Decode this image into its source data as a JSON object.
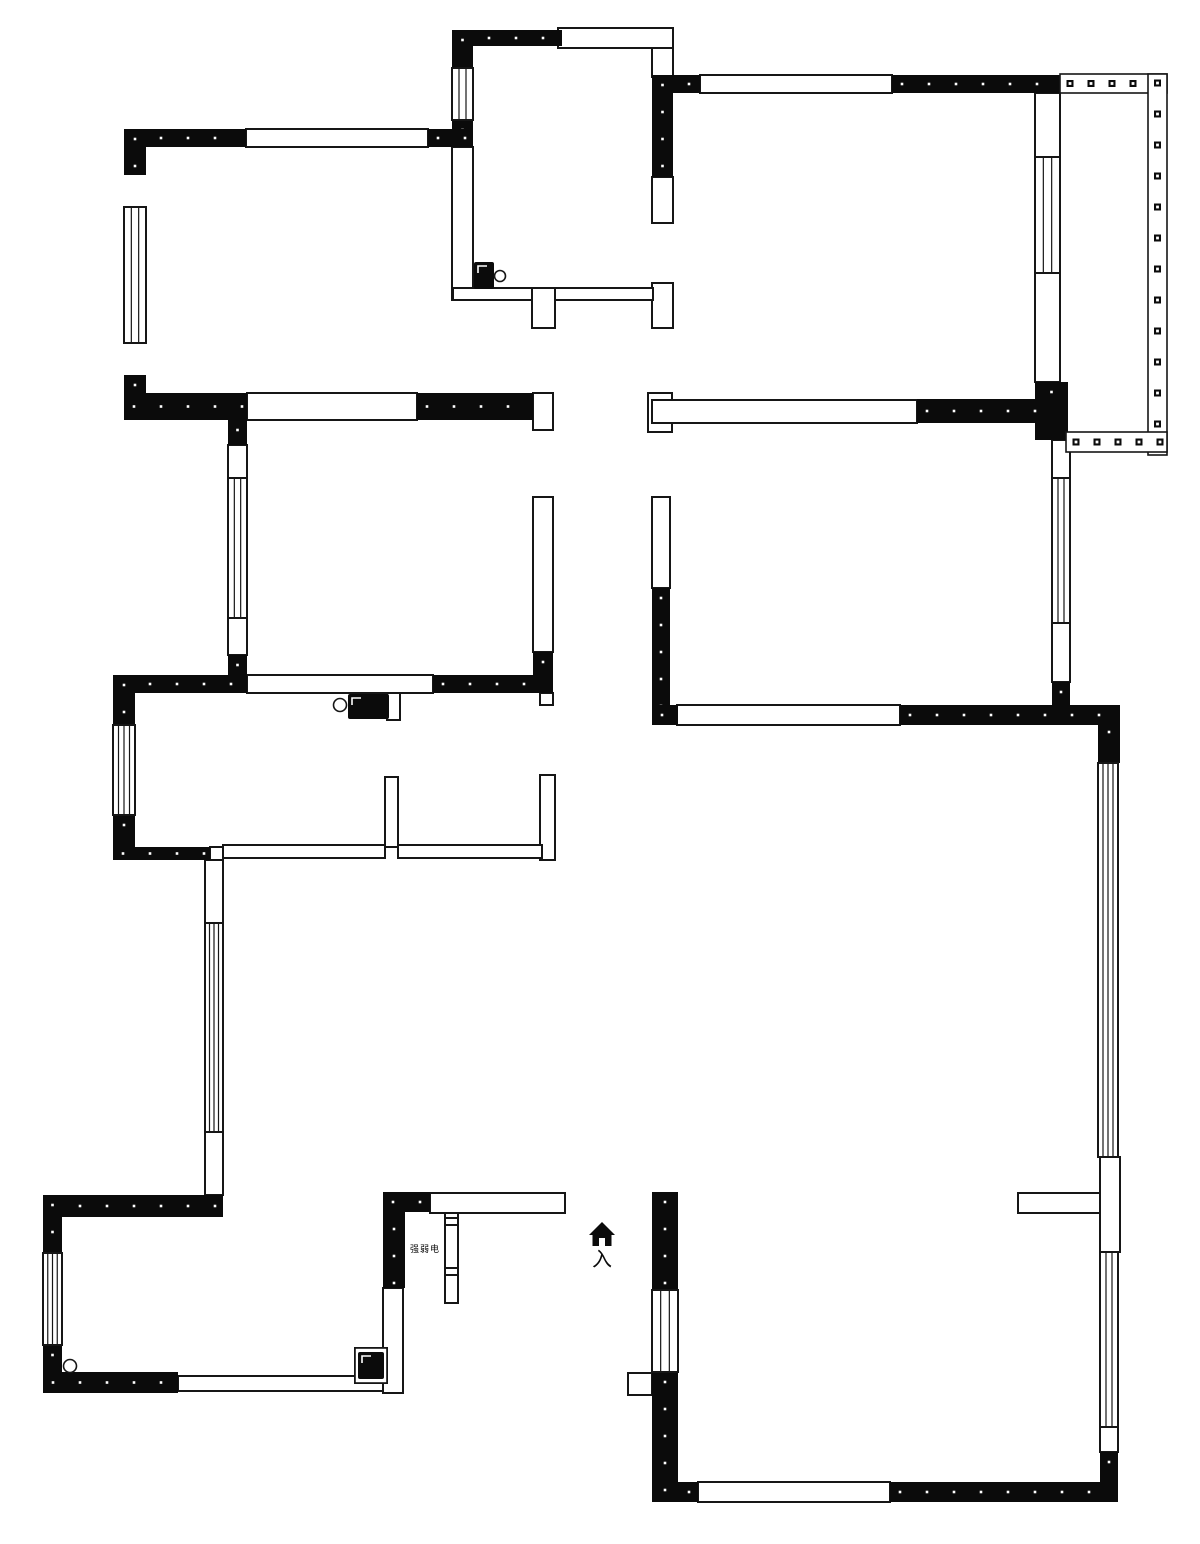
{
  "plan": {
    "canvas": {
      "width": 1200,
      "height": 1544
    },
    "colors": {
      "background": "#ffffff",
      "wall_fill": "#0b0b0b",
      "line": "#161616",
      "dot": "#ffffff"
    },
    "entrance": {
      "label": "入"
    },
    "closet": {
      "label": "强弱电"
    },
    "solid_walls": [
      [
        452,
        30,
        110,
        16
      ],
      [
        452,
        30,
        21,
        38
      ],
      [
        452,
        120,
        21,
        27
      ],
      [
        124,
        129,
        122,
        18
      ],
      [
        428,
        129,
        45,
        18
      ],
      [
        124,
        129,
        22,
        46
      ],
      [
        124,
        375,
        22,
        45
      ],
      [
        652,
        75,
        48,
        18
      ],
      [
        892,
        75,
        168,
        18
      ],
      [
        652,
        75,
        21,
        102
      ],
      [
        1035,
        382,
        33,
        58
      ],
      [
        917,
        399,
        143,
        24
      ],
      [
        124,
        393,
        123,
        27
      ],
      [
        417,
        393,
        116,
        27
      ],
      [
        228,
        420,
        19,
        25
      ],
      [
        228,
        655,
        19,
        38
      ],
      [
        113,
        675,
        134,
        18
      ],
      [
        433,
        675,
        120,
        18
      ],
      [
        113,
        675,
        22,
        50
      ],
      [
        113,
        815,
        22,
        45
      ],
      [
        113,
        847,
        97,
        13
      ],
      [
        533,
        652,
        20,
        41
      ],
      [
        652,
        588,
        18,
        137
      ],
      [
        652,
        705,
        26,
        20
      ],
      [
        900,
        705,
        220,
        20
      ],
      [
        1052,
        682,
        18,
        23
      ],
      [
        1098,
        722,
        22,
        41
      ],
      [
        1100,
        1452,
        18,
        50
      ],
      [
        890,
        1482,
        228,
        20
      ],
      [
        652,
        1482,
        46,
        20
      ],
      [
        652,
        1192,
        26,
        98
      ],
      [
        652,
        1372,
        26,
        130
      ],
      [
        43,
        1195,
        180,
        22
      ],
      [
        43,
        1195,
        19,
        58
      ],
      [
        43,
        1345,
        19,
        48
      ],
      [
        43,
        1372,
        135,
        21
      ],
      [
        383,
        1192,
        22,
        96
      ],
      [
        383,
        1192,
        47,
        20
      ]
    ],
    "outline_walls": [
      [
        558,
        28,
        115,
        20
      ],
      [
        652,
        48,
        21,
        29
      ],
      [
        452,
        147,
        21,
        153
      ],
      [
        246,
        129,
        182,
        18
      ],
      [
        700,
        75,
        192,
        18
      ],
      [
        652,
        177,
        21,
        46
      ],
      [
        652,
        283,
        21,
        45
      ],
      [
        453,
        288,
        200,
        12
      ],
      [
        532,
        288,
        23,
        40
      ],
      [
        1035,
        93,
        25,
        64
      ],
      [
        1035,
        273,
        25,
        109
      ],
      [
        247,
        393,
        170,
        27
      ],
      [
        533,
        393,
        20,
        37
      ],
      [
        648,
        393,
        24,
        39
      ],
      [
        652,
        400,
        265,
        23
      ],
      [
        228,
        445,
        19,
        33
      ],
      [
        228,
        618,
        19,
        37
      ],
      [
        533,
        497,
        20,
        155
      ],
      [
        652,
        497,
        18,
        91
      ],
      [
        1052,
        440,
        18,
        38
      ],
      [
        1052,
        623,
        18,
        59
      ],
      [
        247,
        675,
        186,
        18
      ],
      [
        677,
        705,
        223,
        20
      ],
      [
        540,
        693,
        13,
        12
      ],
      [
        385,
        777,
        13,
        70
      ],
      [
        540,
        775,
        15,
        85
      ],
      [
        210,
        847,
        13,
        13
      ],
      [
        223,
        845,
        162,
        13
      ],
      [
        398,
        845,
        144,
        13
      ],
      [
        205,
        860,
        18,
        63
      ],
      [
        205,
        1132,
        18,
        63
      ],
      [
        1100,
        1157,
        20,
        95
      ],
      [
        1018,
        1193,
        82,
        20
      ],
      [
        1100,
        1427,
        18,
        25
      ],
      [
        698,
        1482,
        192,
        20
      ],
      [
        628,
        1373,
        24,
        22
      ],
      [
        383,
        1288,
        20,
        105
      ],
      [
        430,
        1193,
        135,
        20
      ],
      [
        445,
        1213,
        13,
        90
      ],
      [
        445,
        1218,
        13,
        7
      ],
      [
        445,
        1268,
        13,
        7
      ],
      [
        178,
        1376,
        205,
        15
      ],
      [
        355,
        1348,
        32,
        35
      ],
      [
        387,
        693,
        13,
        27
      ]
    ],
    "windows": [
      [
        124,
        207,
        22,
        136,
        2
      ],
      [
        452,
        68,
        21,
        52,
        2
      ],
      [
        228,
        478,
        19,
        140,
        2
      ],
      [
        113,
        725,
        22,
        90,
        3
      ],
      [
        43,
        1253,
        19,
        92,
        3
      ],
      [
        205,
        923,
        18,
        209,
        3
      ],
      [
        1035,
        157,
        25,
        116,
        2
      ],
      [
        1052,
        478,
        18,
        145,
        2
      ],
      [
        1098,
        763,
        20,
        394,
        3
      ],
      [
        1100,
        1252,
        18,
        175,
        2
      ],
      [
        652,
        1290,
        26,
        82,
        2
      ]
    ],
    "railings": [
      [
        1060,
        74,
        107,
        19,
        "h"
      ],
      [
        1148,
        74,
        19,
        381,
        "v"
      ],
      [
        1066,
        432,
        101,
        20,
        "h"
      ]
    ],
    "fixtures": {
      "toilet": {
        "box": [
          474,
          262,
          20,
          27
        ],
        "circle": [
          500,
          276,
          5.5
        ]
      },
      "stove": {
        "box": [
          348,
          694,
          41,
          25
        ],
        "circle": [
          340,
          705,
          6.5
        ]
      },
      "water_heater": {
        "outer": [
          355,
          1348,
          32,
          35
        ],
        "box": [
          358,
          1352,
          26,
          27
        ]
      },
      "floor_drain": {
        "circle": [
          70,
          1366,
          6.5
        ]
      },
      "entrance_icon": {
        "cx": 602,
        "top": 1222
      }
    },
    "label_positions": {
      "entrance": {
        "x": 602,
        "y": 1266,
        "size": 20
      },
      "closet": {
        "x": 425,
        "y": 1252,
        "size": 9
      }
    }
  }
}
